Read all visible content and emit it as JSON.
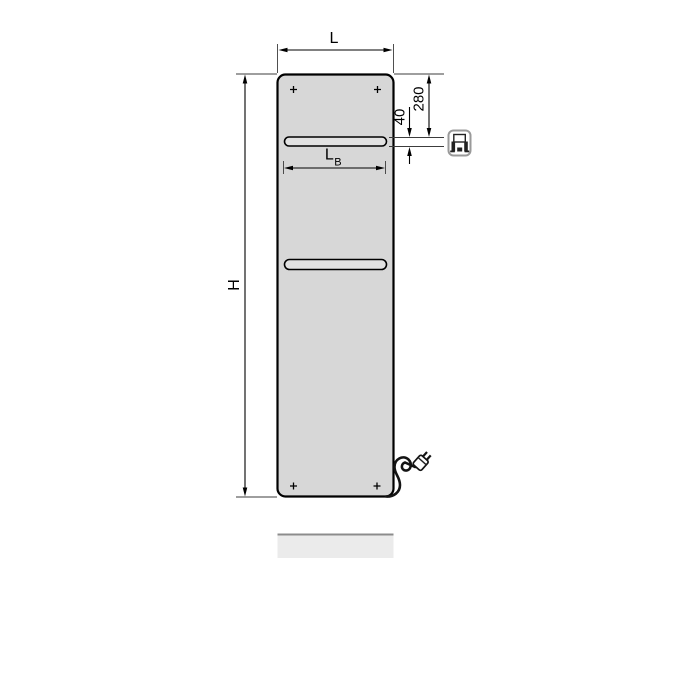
{
  "diagram": {
    "description": "Panel radiator dimension drawing",
    "labels": {
      "width": "L",
      "height": "H",
      "bar_width_main": "L",
      "bar_width_sub": "B",
      "top_offset": "280",
      "bar_height": "40"
    },
    "icons": {
      "electric_connection": "electric-connection-icon",
      "power_plug": "power-plug-icon",
      "mounting_marks": "mounting-cross-icon"
    },
    "colors": {
      "background": "#ffffff",
      "panel_fill": "#d7d7d7",
      "bar_fill": "#e2e2e2",
      "outline": "#000000",
      "dim_line": "#3c3c3c",
      "cable": "#141414",
      "floor_fill": "#ebebeb",
      "floor_edge": "#8c8c8c",
      "icon_border": "#9a9a9a",
      "icon_ink": "#222222"
    }
  }
}
